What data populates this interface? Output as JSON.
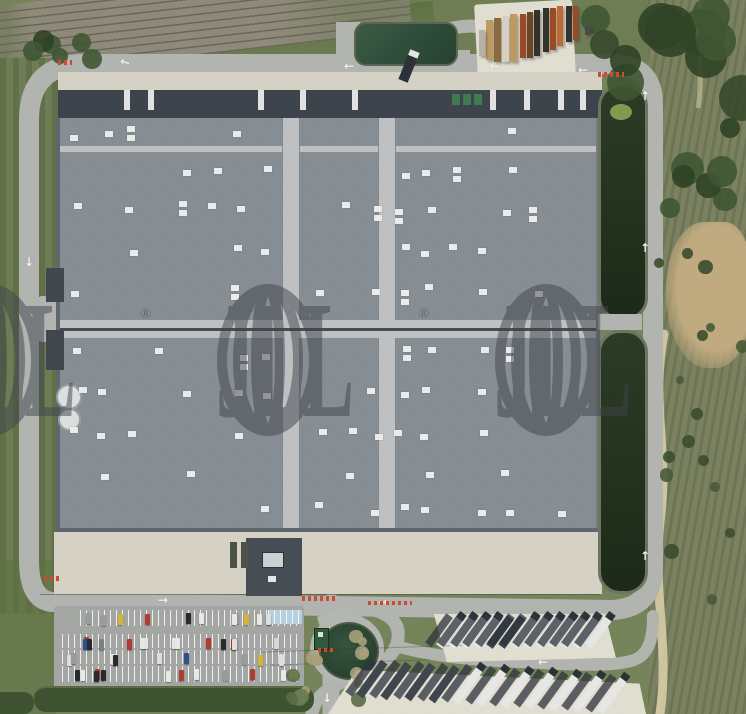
{
  "image": {
    "type": "aerial-satellite-photo",
    "subject": "logistics-warehouse-site"
  },
  "watermark": {
    "text": "JLL",
    "registered": "®",
    "color": "#3e434a",
    "opacity": 0.5,
    "groups": 3
  },
  "palette": {
    "grass": "#76845a",
    "grassDark": "#5c7242",
    "grassDim": "#6e7d54",
    "scrub": "#7b8260",
    "dirt": "#c2ab7f",
    "pathc": "#d9cfa6",
    "road": "#b3b5b1",
    "concrete": "#d7d3c7",
    "concreteBright": "#e2dfd3",
    "roof": "#878e94",
    "roofSeam": "#bfc2c3",
    "roofDark": "#454b52",
    "roofEdge": "#5f666d",
    "dock": "#3c434a",
    "skylight": "#edeeee",
    "basin": "#23301c",
    "basinRim": "#6d7560",
    "algae": "#7e9c50",
    "pond": "#2d4836",
    "pondRim": "#b5b7b3",
    "hedge": "#3c5230",
    "tree": "#3e5531",
    "treeDark": "#2e4124",
    "rail": "#8f8a7a",
    "railTie": "#6a665a",
    "lot": "#a4a7a3",
    "blueBay": "#b7d2e0",
    "trailerWhite": "#e9e9e7",
    "truckDark": "#3f454d",
    "cab": "#2b3038",
    "reddash": "#cf4a30",
    "wm": "#3e434a"
  },
  "sprites": {
    "bushTL": {
      "kind": "scatter",
      "seed": 21,
      "count": 6,
      "x": [
        2,
        92
      ],
      "y": [
        28,
        52
      ],
      "r": [
        7,
        13
      ],
      "colors": [
        "#3e5531",
        "#2e4124"
      ]
    },
    "canopyTR": {
      "kind": "scatter",
      "seed": 13,
      "count": 11,
      "x": [
        580,
        740
      ],
      "y": [
        -6,
        118
      ],
      "r": [
        14,
        30
      ],
      "colors": [
        "#2e4124",
        "#3e5531",
        "#35492a"
      ]
    },
    "canopyR": {
      "kind": "scatter",
      "seed": 17,
      "count": 7,
      "x": [
        655,
        740
      ],
      "y": [
        80,
        215
      ],
      "r": [
        9,
        20
      ],
      "colors": [
        "#3e5531",
        "#2e4124"
      ]
    },
    "fieldTrees": {
      "kind": "scatter",
      "seed": 11,
      "count": 16,
      "x": [
        652,
        738
      ],
      "y": [
        230,
        600
      ],
      "r": [
        3,
        8
      ],
      "colors": [
        "#465a36",
        "#3a4c2c"
      ]
    },
    "shrubsA": {
      "kind": "scatter",
      "seed": 5,
      "count": 9,
      "x": [
        286,
        312
      ],
      "y": [
        636,
        706
      ],
      "r": [
        4,
        8
      ],
      "colors": [
        "#5a6c44",
        "#a9a27b",
        "#6d7c52"
      ]
    },
    "shrubsB": {
      "kind": "scatter",
      "seed": 9,
      "count": 7,
      "x": [
        344,
        360
      ],
      "y": [
        626,
        702
      ],
      "r": [
        4,
        8
      ],
      "colors": [
        "#5a6c44",
        "#a9a27b"
      ]
    },
    "skylights": {
      "kind": "grid",
      "seed": 7,
      "colFrom": 74,
      "colTo": 586,
      "colStep": 27,
      "rows": [
        130,
        168,
        206,
        246,
        288,
        350,
        390,
        430,
        470,
        506
      ],
      "skipX": [
        [
          276,
          302
        ],
        [
          372,
          398
        ]
      ],
      "presence": 0.52,
      "jitter": 5,
      "w": 8,
      "h": 6,
      "doubleChance": 0.16
    },
    "carsRow1": {
      "kind": "cars",
      "seed": 3,
      "count": 12,
      "x": [
        86,
        296
      ],
      "y": 612,
      "w": 5,
      "h": 11
    },
    "carsRow2": {
      "kind": "cars",
      "seed": 4,
      "count": 15,
      "x": [
        66,
        296
      ],
      "y": 636,
      "w": 5,
      "h": 11
    },
    "carsRow3": {
      "kind": "cars",
      "seed": 6,
      "count": 10,
      "x": [
        66,
        296
      ],
      "y": 652,
      "w": 5,
      "h": 11
    },
    "carsRow4": {
      "kind": "cars",
      "seed": 8,
      "count": 11,
      "x": [
        66,
        296
      ],
      "y": 668,
      "w": 5,
      "h": 11
    },
    "carColors": [
      "#ebebe9",
      "#ebebe9",
      "#d9dad8",
      "#26292d",
      "#26292d",
      "#9a9da0",
      "#b23a2e",
      "#2a4f8f",
      "#d8b33a",
      "#ebebe9",
      "#7d8084",
      "#e0e0de"
    ],
    "trucksTop": {
      "kind": "trucks",
      "count": 13,
      "x0": 446,
      "dx": 12.4,
      "y": 614,
      "dy": 0,
      "len": 36,
      "w": 8,
      "rot": 36,
      "darks": [
        4,
        5
      ]
    },
    "trucksBottom": {
      "kind": "trucks",
      "count": 11,
      "x0": 368,
      "dx": 24,
      "y": 658,
      "dy": 1.6,
      "len": 42,
      "w": 8,
      "rot": 36,
      "darks": [
        0,
        1,
        2,
        3
      ]
    },
    "dockTrailers": {
      "kind": "vrects",
      "xs": [
        124,
        148,
        258,
        300,
        352,
        490,
        524,
        558,
        580
      ],
      "y": 90,
      "w": 6,
      "h": 20,
      "color": "#e4e5e2"
    },
    "dockContainers": {
      "kind": "vrects",
      "xs": [
        452,
        463,
        474
      ],
      "y": 94,
      "w": 8,
      "h": 11,
      "color": "#3e7a50"
    },
    "stacks": {
      "kind": "rects",
      "items": [
        [
          486,
          20,
          7,
          40,
          "#c09a62"
        ],
        [
          494,
          18,
          7,
          44,
          "#8a6a3e"
        ],
        [
          502,
          16,
          7,
          46,
          "#d9d2c4"
        ],
        [
          510,
          14,
          7,
          48,
          "#c09a62"
        ],
        [
          520,
          14,
          6,
          44,
          "#9c4a22"
        ],
        [
          527,
          12,
          6,
          46,
          "#6b4526"
        ],
        [
          534,
          10,
          6,
          46,
          "#33302a"
        ],
        [
          543,
          8,
          6,
          44,
          "#33302a"
        ],
        [
          550,
          8,
          6,
          42,
          "#9c4a22"
        ],
        [
          557,
          6,
          6,
          40,
          "#c06a30"
        ],
        [
          566,
          6,
          6,
          36,
          "#33302a"
        ],
        [
          573,
          6,
          5,
          34,
          "#9c4a22"
        ],
        [
          479,
          30,
          6,
          26,
          "#b8b2a4"
        ],
        [
          585,
          26,
          6,
          9,
          "#4a4a46"
        ]
      ]
    },
    "arrows": {
      "kind": "arrows",
      "items": [
        [
          120,
          56,
          "←",
          18
        ],
        [
          344,
          60,
          "←",
          0
        ],
        [
          578,
          64,
          "←",
          0
        ],
        [
          490,
          60,
          "←",
          0
        ],
        [
          24,
          256,
          "↓",
          0
        ],
        [
          640,
          90,
          "↑",
          0
        ],
        [
          640,
          242,
          "↑",
          0
        ],
        [
          640,
          550,
          "↑",
          0
        ],
        [
          158,
          594,
          "→",
          0
        ],
        [
          378,
          596,
          "→",
          0
        ],
        [
          322,
          692,
          "↓",
          0
        ],
        [
          538,
          656,
          "←",
          0
        ]
      ]
    },
    "redDashes": {
      "kind": "dashes",
      "items": [
        [
          44,
          576,
          18,
          5
        ],
        [
          302,
          596,
          36,
          5
        ],
        [
          598,
          72,
          26,
          5
        ],
        [
          318,
          648,
          16,
          4
        ],
        [
          58,
          60,
          14,
          5
        ],
        [
          368,
          601,
          44,
          4
        ]
      ]
    }
  }
}
